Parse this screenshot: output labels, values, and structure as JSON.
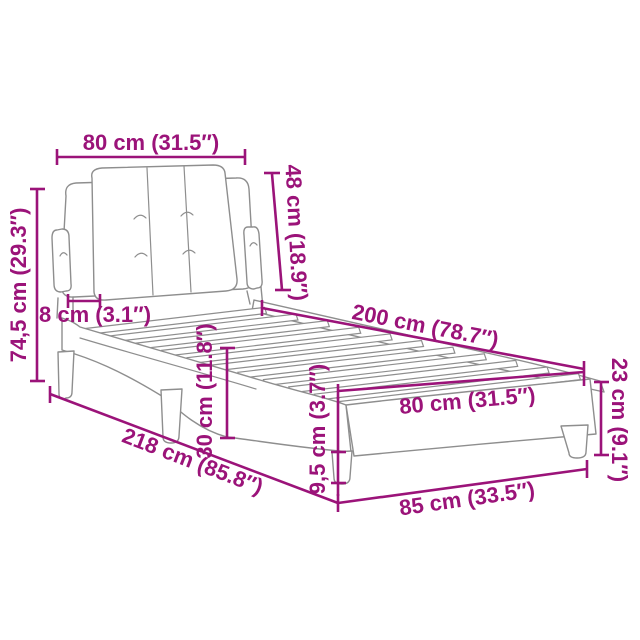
{
  "meta": {
    "description": "Product dimension diagram of an upholstered bed frame with tufted headboard and slatted base",
    "accent_color": "#9B1379",
    "outline_color": "#8E8E8E",
    "background_color": "#FFFFFF"
  },
  "dimensions": {
    "headboard_width": "80 cm (31.5″)",
    "headboard_height": "48 cm (18.9″)",
    "overall_height": "74,5 cm (29.3″)",
    "headboard_depth": "8 cm (3.1″)",
    "bed_length": "200 cm (78.7″)",
    "frame_height": "30 cm (11.8″)",
    "slat_base_width": "80 cm (31.5″)",
    "foot_height": "23 cm (9.1″)",
    "overall_length": "218 cm (85.8″)",
    "leg_height": "9,5 cm (3.7″)",
    "foot_width": "85 cm (33.5″)"
  }
}
